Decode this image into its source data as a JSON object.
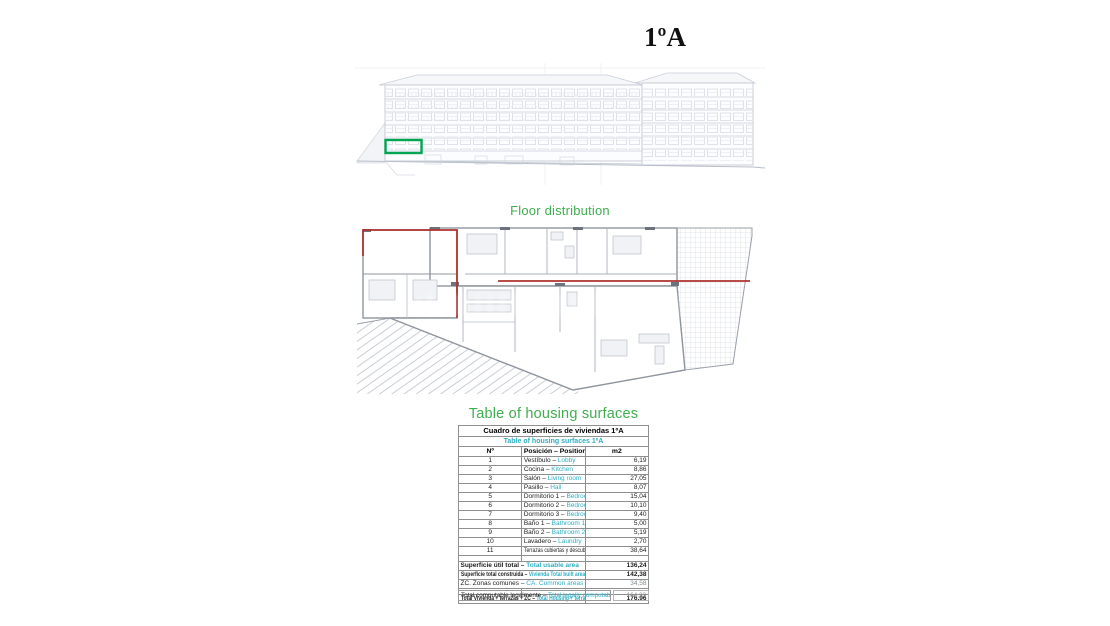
{
  "page": {
    "title": "1ºA"
  },
  "elevation": {
    "highlight_color": "#00a551"
  },
  "floor_plan": {
    "heading": "Floor distribution",
    "boundary_color": "#b03231"
  },
  "surfaces": {
    "heading": "Table of housing surfaces",
    "title_es": "Cuadro de superficies de viviendas 1ºA",
    "title_en": "Table of housing surfaces 1ºA",
    "columns": {
      "num": "Nº",
      "position": "Posición – Position",
      "area": "m2"
    },
    "separator": "–",
    "rows": [
      {
        "num": "1",
        "es": "Vestíbulo",
        "en": "Lobby",
        "m2": "6,19"
      },
      {
        "num": "2",
        "es": "Cocina",
        "en": "Kitchen",
        "m2": "8,86"
      },
      {
        "num": "3",
        "es": "Salón",
        "en": "Living room",
        "m2": "27,05"
      },
      {
        "num": "4",
        "es": "Pasillo",
        "en": "Hall",
        "m2": "8,07"
      },
      {
        "num": "5",
        "es": "Dormitorio 1",
        "en": "Bedroom 1",
        "m2": "15,04"
      },
      {
        "num": "6",
        "es": "Dormitorio 2",
        "en": "Bedroom 2",
        "m2": "10,10"
      },
      {
        "num": "7",
        "es": "Dormitorio 3",
        "en": "Bedroom 3",
        "m2": "9,40"
      },
      {
        "num": "8",
        "es": "Baño 1",
        "en": "Bathroom 1",
        "m2": "5,00"
      },
      {
        "num": "9",
        "es": "Baño 2",
        "en": "Bathroom 2",
        "m2": "5,19"
      },
      {
        "num": "10",
        "es": "Lavadero",
        "en": "Laundry",
        "m2": "2,70"
      },
      {
        "num": "11",
        "es": "Terrazas cubiertas y descubiertas",
        "en": "Covered and uncovered terraces",
        "m2": "38,64"
      }
    ],
    "totals": [
      {
        "es": "Superficie útil total",
        "en": "Total usable area",
        "m2": "136,24",
        "bold": true
      },
      {
        "es": "Superficie total construida",
        "en": "Vivienda Total built area - Housing",
        "m2": "142,38",
        "bold": true
      },
      {
        "es": "ZC. Zonas comunes",
        "en": "CA. Common areas",
        "m2": "34,58",
        "bold": false,
        "dim_value": true
      },
      {
        "es": "Total Vivienda + terrazas + ZC",
        "en": "Total Housing + terraces + CA",
        "m2": "176,96",
        "bold": true,
        "grand": true
      }
    ],
    "legal": {
      "es": "Total computable legalmente",
      "en": "Total legally computable",
      "m2": "164,33"
    }
  },
  "colors": {
    "green_heading": "#3fae4f",
    "teal_text": "#2faec3",
    "red_boundary": "#b03231",
    "highlight_green": "#00a551"
  }
}
